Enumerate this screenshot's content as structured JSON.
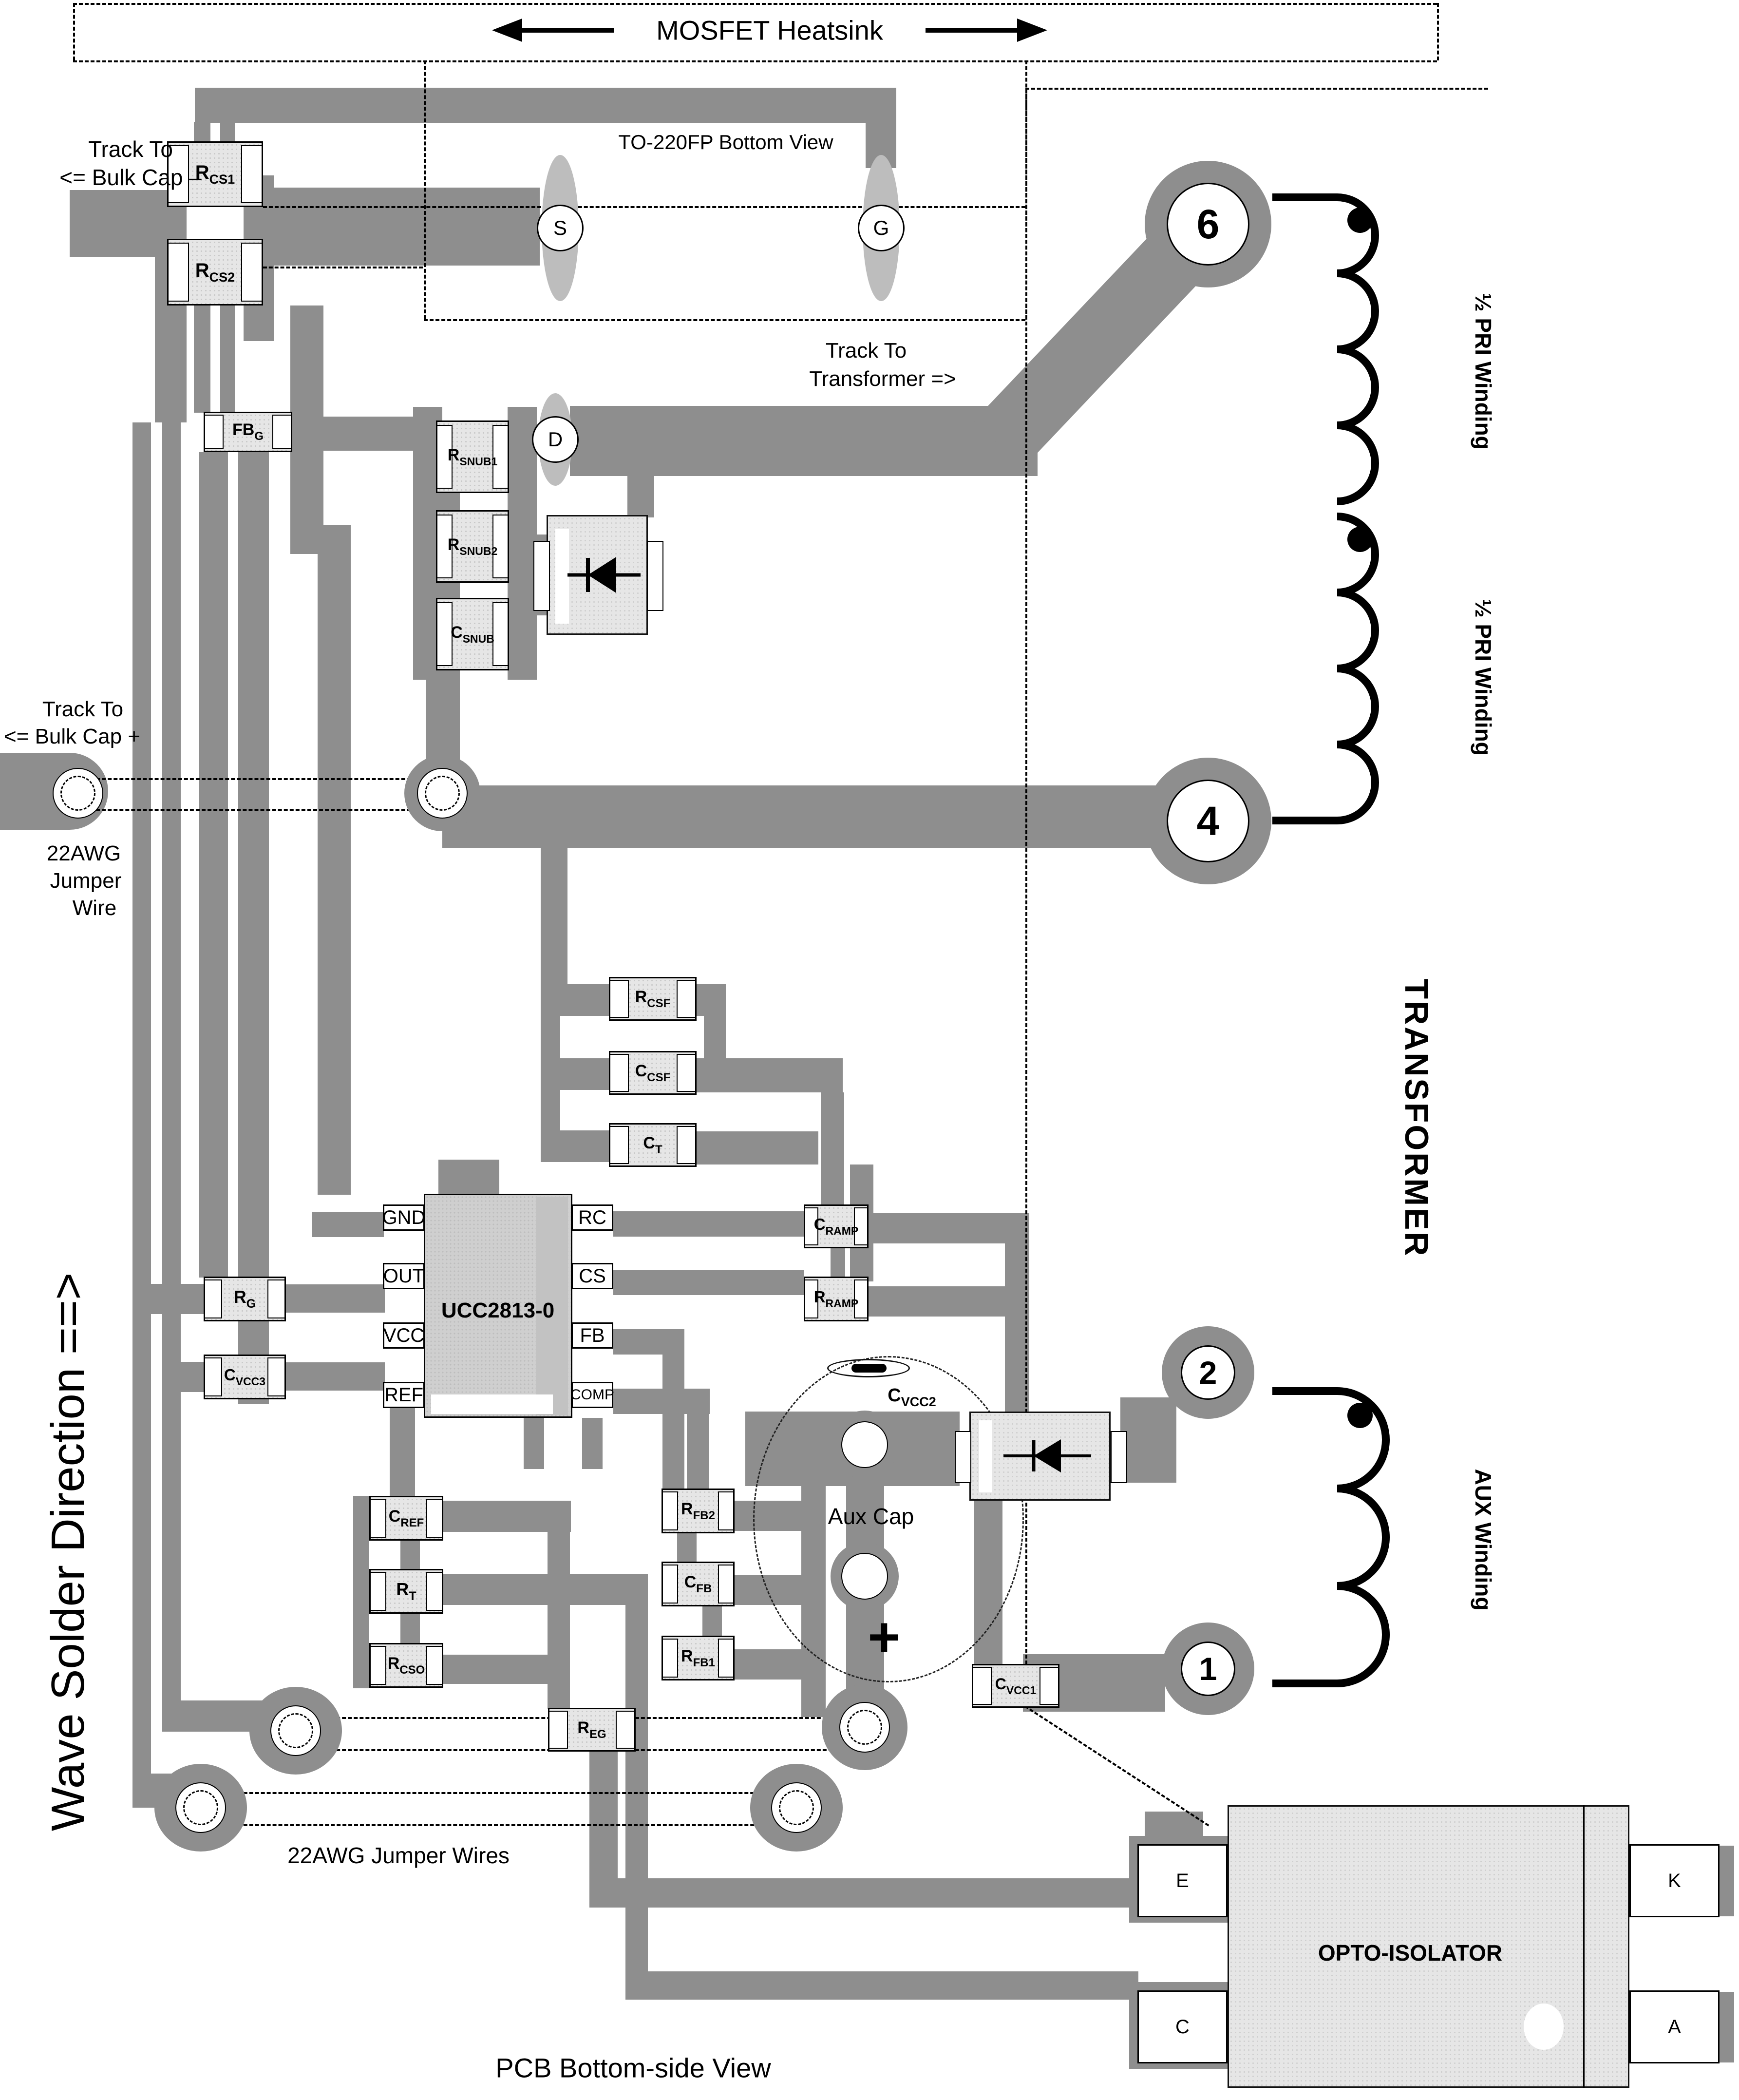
{
  "colors": {
    "trace": "#8e8e8e",
    "component_body": "#e6e6e6",
    "ic_body": "#cfcfcf",
    "pad": "#ffffff",
    "text": "#000000"
  },
  "header": {
    "heatsink_label": "MOSFET Heatsink",
    "to220_label": "TO-220FP Bottom View"
  },
  "annotations": {
    "track_bulk_minus_1": "Track To",
    "track_bulk_minus_2": "<=  Bulk Cap –",
    "track_transformer_1": "Track To",
    "track_transformer_2": "Transformer  =>",
    "track_bulk_plus_1": "Track To",
    "track_bulk_plus_2": "<=  Bulk Cap +",
    "jumper_wire_1": "22AWG",
    "jumper_wire_2": "Jumper",
    "jumper_wire_3": "Wire",
    "jumper_wires": "22AWG Jumper Wires",
    "wave_solder": "Wave Solder Direction ==>",
    "pcb_view": "PCB Bottom-side View",
    "aux_cap": "Aux Cap",
    "aux_plus": "+"
  },
  "mosfet_pads": {
    "source": "S",
    "gate": "G",
    "drain": "D"
  },
  "transformer": {
    "title": "TRANSFORMER",
    "pin6": "6",
    "pin4": "4",
    "pin2": "2",
    "pin1": "1",
    "pri1": "½ PRI Winding",
    "pri2": "½ PRI Winding",
    "aux": "AUX Winding"
  },
  "ic": {
    "name": "UCC2813-0",
    "pin_gnd": "GND",
    "pin_out": "OUT",
    "pin_vcc": "VCC",
    "pin_ref": "REF",
    "pin_rc": "RC",
    "pin_cs": "CS",
    "pin_fb": "FB",
    "pin_comp": "COMP"
  },
  "opto": {
    "name": "OPTO-ISOLATOR",
    "pin_e": "E",
    "pin_c": "C",
    "pin_k": "K",
    "pin_a": "A"
  },
  "components": {
    "rcs1": {
      "m": "R",
      "s": "CS1"
    },
    "rcs2": {
      "m": "R",
      "s": "CS2"
    },
    "fbg": {
      "m": "FB",
      "s": "G"
    },
    "rsnub1": {
      "m": "R",
      "s": "SNUB1"
    },
    "rsnub2": {
      "m": "R",
      "s": "SNUB2"
    },
    "csnub": {
      "m": "C",
      "s": "SNUB"
    },
    "rcsf": {
      "m": "R",
      "s": "CSF"
    },
    "ccsf": {
      "m": "C",
      "s": "CSF"
    },
    "ct": {
      "m": "C",
      "s": "T"
    },
    "cramp": {
      "m": "C",
      "s": "RAMP"
    },
    "rramp": {
      "m": "R",
      "s": "RAMP"
    },
    "rg": {
      "m": "R",
      "s": "G"
    },
    "cvcc3": {
      "m": "C",
      "s": "VCC3"
    },
    "cref": {
      "m": "C",
      "s": "REF"
    },
    "rt": {
      "m": "R",
      "s": "T"
    },
    "rcso": {
      "m": "R",
      "s": "CSO"
    },
    "rfb2": {
      "m": "R",
      "s": "FB2"
    },
    "cfb": {
      "m": "C",
      "s": "FB"
    },
    "rfb1": {
      "m": "R",
      "s": "FB1"
    },
    "reg": {
      "m": "R",
      "s": "EG"
    },
    "cvcc1": {
      "m": "C",
      "s": "VCC1"
    },
    "cvcc2": {
      "m": "C",
      "s": "VCC2"
    }
  }
}
